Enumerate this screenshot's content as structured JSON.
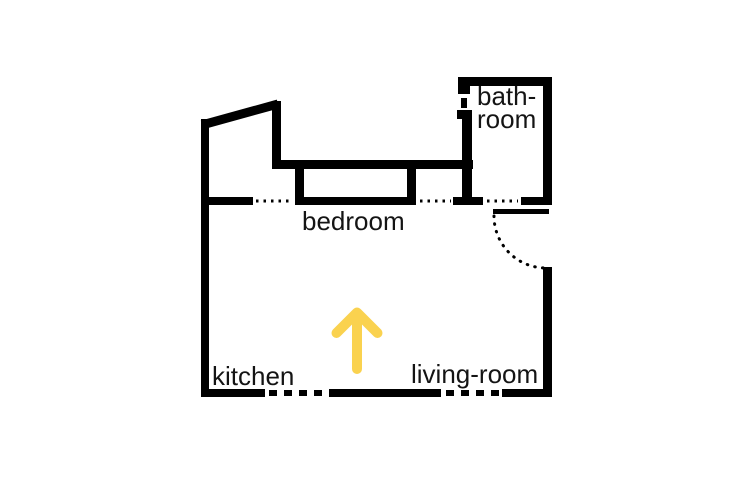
{
  "floor_plan": {
    "background_color": "#ffffff",
    "wall_color": "#000000",
    "text_color": "#141414",
    "arrow_color": "#fad24f",
    "labels": {
      "bedroom": "bedroom",
      "kitchen": "kitchen",
      "living_room": "living-room",
      "bathroom_line1": "bath-",
      "bathroom_line2": "room"
    },
    "arrow": {
      "direction": "up"
    }
  }
}
